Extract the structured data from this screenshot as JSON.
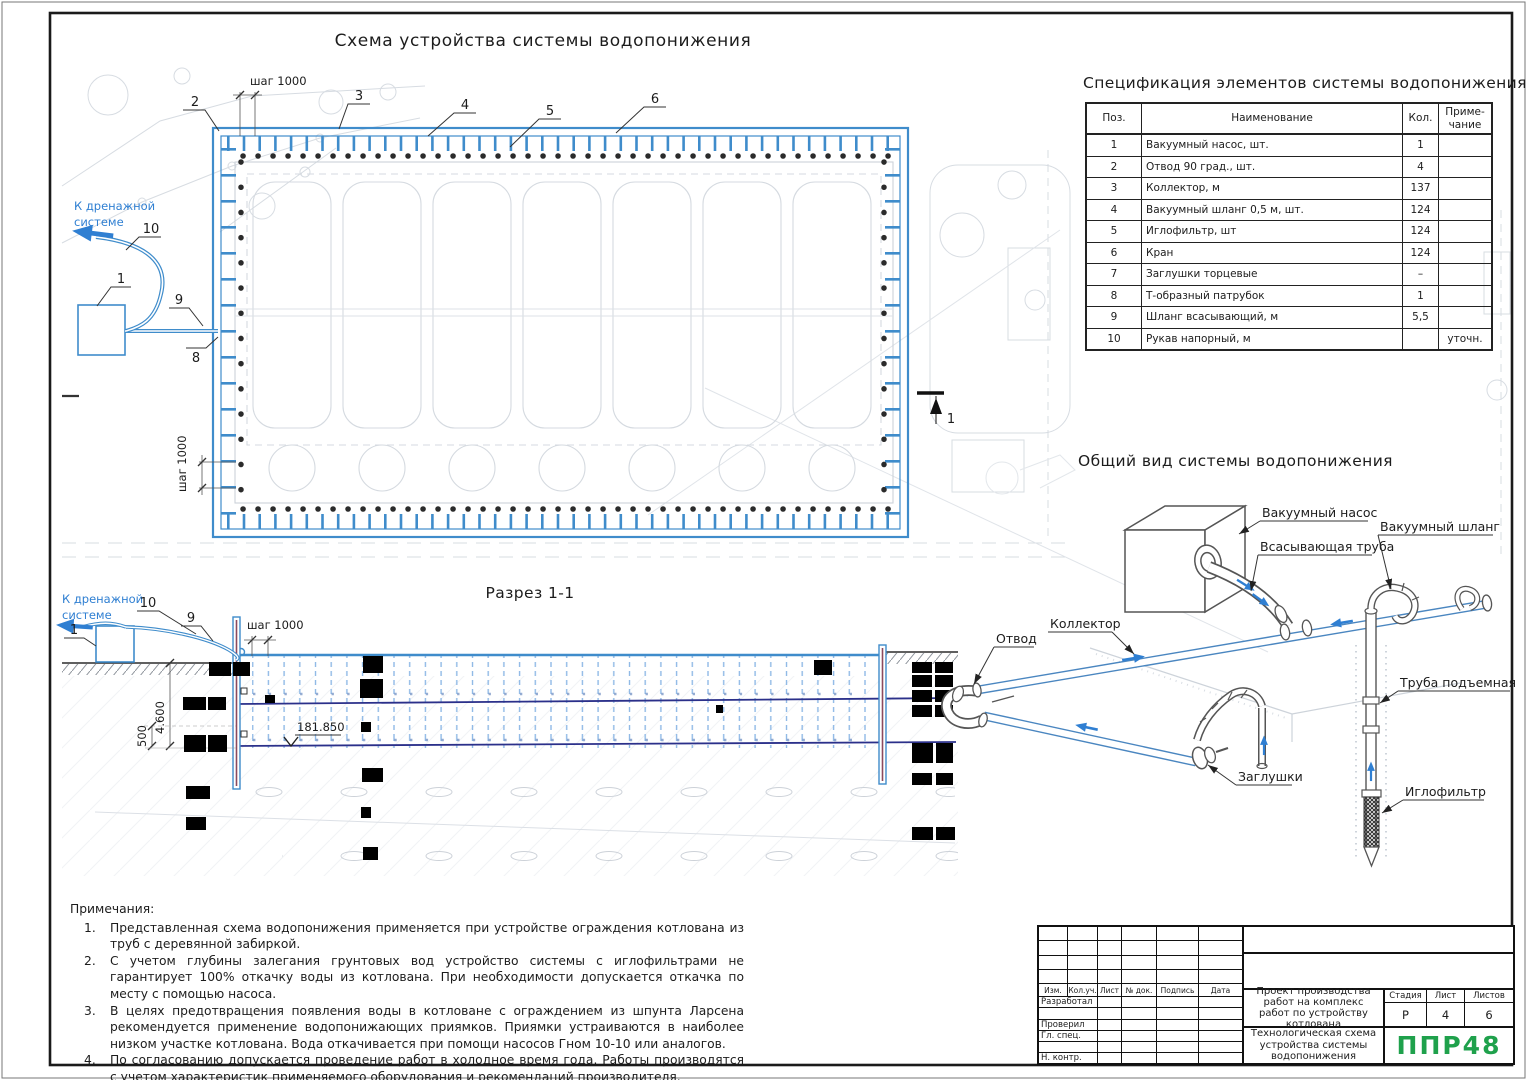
{
  "titles": {
    "plan": "Схема устройства системы водопонижения",
    "section": "Разрез 1-1",
    "spec": "Спецификация элементов системы водопонижения",
    "overview": "Общий вид системы водопонижения"
  },
  "shared": {
    "step": "шаг 1000",
    "drain1": "К дренажной",
    "drain2": "системе"
  },
  "plan": {
    "callouts": {
      "n1": "1",
      "n2": "2",
      "n3": "3",
      "n4": "4",
      "n5": "5",
      "n6": "6",
      "n8": "8",
      "n9": "9",
      "n10": "10"
    },
    "section_mark": "1"
  },
  "section": {
    "callouts": {
      "pump": "1",
      "hose": "9",
      "sleeve": "10"
    },
    "dims": {
      "depth": "4.600",
      "offset": "500",
      "level": "181.850"
    }
  },
  "overview": {
    "labels": {
      "pump": "Вакуумный насос",
      "vac_hose": "Вакуумный шланг",
      "suction": "Всасывающая труба",
      "collector": "Коллектор",
      "otvod": "Отвод",
      "riser": "Труба подъемная",
      "plugs": "Заглушки",
      "filter": "Иглофильтр"
    }
  },
  "spec": {
    "headers": {
      "pos": "Поз.",
      "name": "Наименование",
      "qty": "Кол.",
      "note": "Приме-\nчание"
    },
    "rows": [
      {
        "pos": "1",
        "name": "Вакуумный насос, шт.",
        "qty": "1",
        "note": ""
      },
      {
        "pos": "2",
        "name": "Отвод 90 град., шт.",
        "qty": "4",
        "note": ""
      },
      {
        "pos": "3",
        "name": "Коллектор, м",
        "qty": "137",
        "note": ""
      },
      {
        "pos": "4",
        "name": "Вакуумный шланг 0,5 м, шт.",
        "qty": "124",
        "note": ""
      },
      {
        "pos": "5",
        "name": "Иглофильтр, шт",
        "qty": "124",
        "note": ""
      },
      {
        "pos": "6",
        "name": "Кран",
        "qty": "124",
        "note": ""
      },
      {
        "pos": "7",
        "name": "Заглушки торцевые",
        "qty": "–",
        "note": ""
      },
      {
        "pos": "8",
        "name": "Т-образный патрубок",
        "qty": "1",
        "note": ""
      },
      {
        "pos": "9",
        "name": "Шланг всасывающий, м",
        "qty": "5,5",
        "note": ""
      },
      {
        "pos": "10",
        "name": "Рукав напорный, м",
        "qty": "",
        "note": "уточн."
      }
    ]
  },
  "notes": {
    "title": "Примечания:",
    "items": [
      {
        "num": "1.",
        "text": "Представленная схема водопонижения применяется при устройстве ограждения котлована из труб с деревянной забиркой."
      },
      {
        "num": "2.",
        "text": "С учетом глубины залегания грунтовых вод устройство системы с иглофильтрами не гарантирует 100% откачку воды из котлована. При необходимости допускается откачка по месту с помощью насоса."
      },
      {
        "num": "3.",
        "text": "В целях предотвращения появления воды в котловане с ограждением из шпунта Ларсена рекомендуется применение водопонижающих приямков. Приямки устраиваются в наиболее низком участке котлована. Вода откачивается при помощи насосов Гном 10-10 или аналогов."
      },
      {
        "num": "4.",
        "text": "По согласованию допускается проведение работ в холодное время года. Работы производятся с учетом характеристик применяемого оборудования и рекомендаций производителя."
      }
    ]
  },
  "tb": {
    "cols": [
      "Изм.",
      "Кол.уч.",
      "Лист",
      "№ док.",
      "Подпись",
      "Дата"
    ],
    "rows": [
      "Разработал",
      "",
      "Проверил",
      "Гл. спец.",
      "",
      "Н. контр."
    ],
    "project": "Проект производства работ на комплекс работ по устройству котлована",
    "doc": "Технологическая схема устройства системы водопонижения",
    "stage_label": "Стадия",
    "sheet_label": "Лист",
    "sheets_label": "Листов",
    "stage": "Р",
    "sheet": "4",
    "sheets": "6",
    "logo": "ППР48"
  },
  "colors": {
    "blue": "#3f8ccb",
    "light_blue": "#8fb9e6",
    "navy": "#2b308a",
    "green": "#1fa14c"
  }
}
